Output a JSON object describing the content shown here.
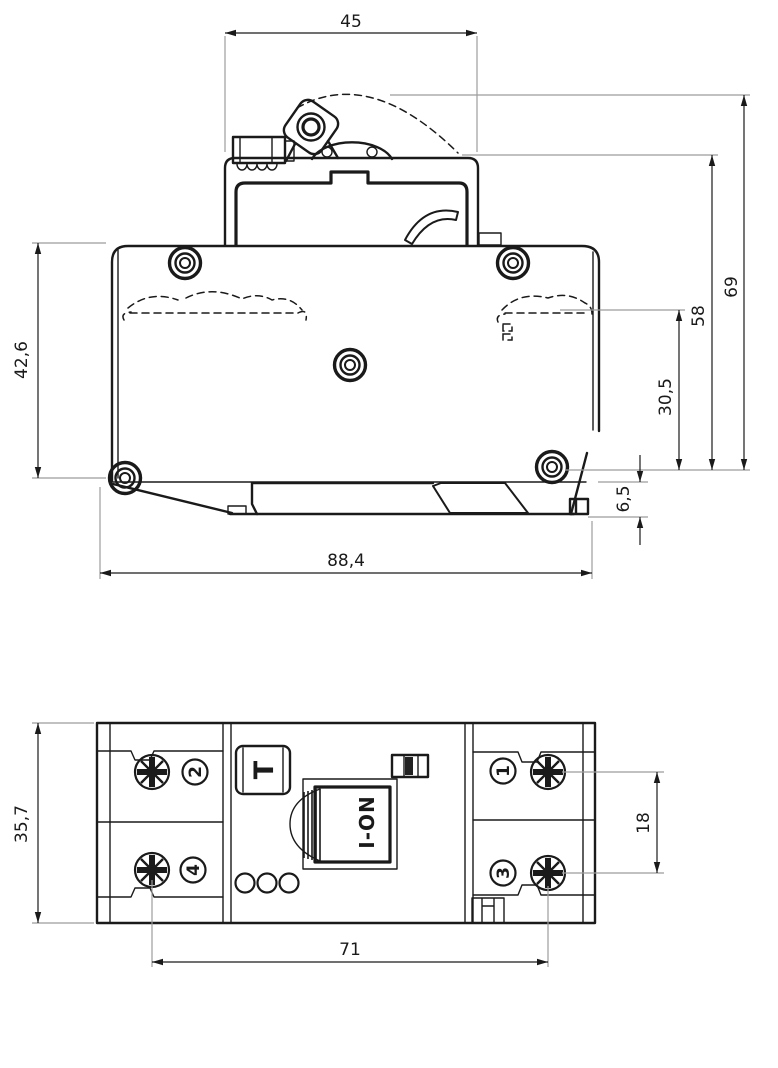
{
  "drawing": {
    "kind": "technical-drawing",
    "views": [
      "side-elevation",
      "top-face"
    ]
  },
  "colors": {
    "line": "#1a1a1a",
    "extension": "#9c9c9c",
    "indicator_fill": "#222222",
    "background": "#ffffff"
  },
  "side_view": {
    "dimensions": {
      "top_width": "45",
      "total_height": "69",
      "upper_height": "58",
      "clip_height": "30,5",
      "rail_offset": "6,5",
      "body_height": "42,6",
      "overall_length": "88,4"
    }
  },
  "top_view": {
    "dimensions": {
      "width": "35,7",
      "terminal_pitch": "18",
      "mounting_distance": "71"
    },
    "labels": {
      "test_button": "T",
      "switch": "I-ON",
      "terminal_1": "1",
      "terminal_2": "2",
      "terminal_3": "3",
      "terminal_4": "4"
    }
  }
}
